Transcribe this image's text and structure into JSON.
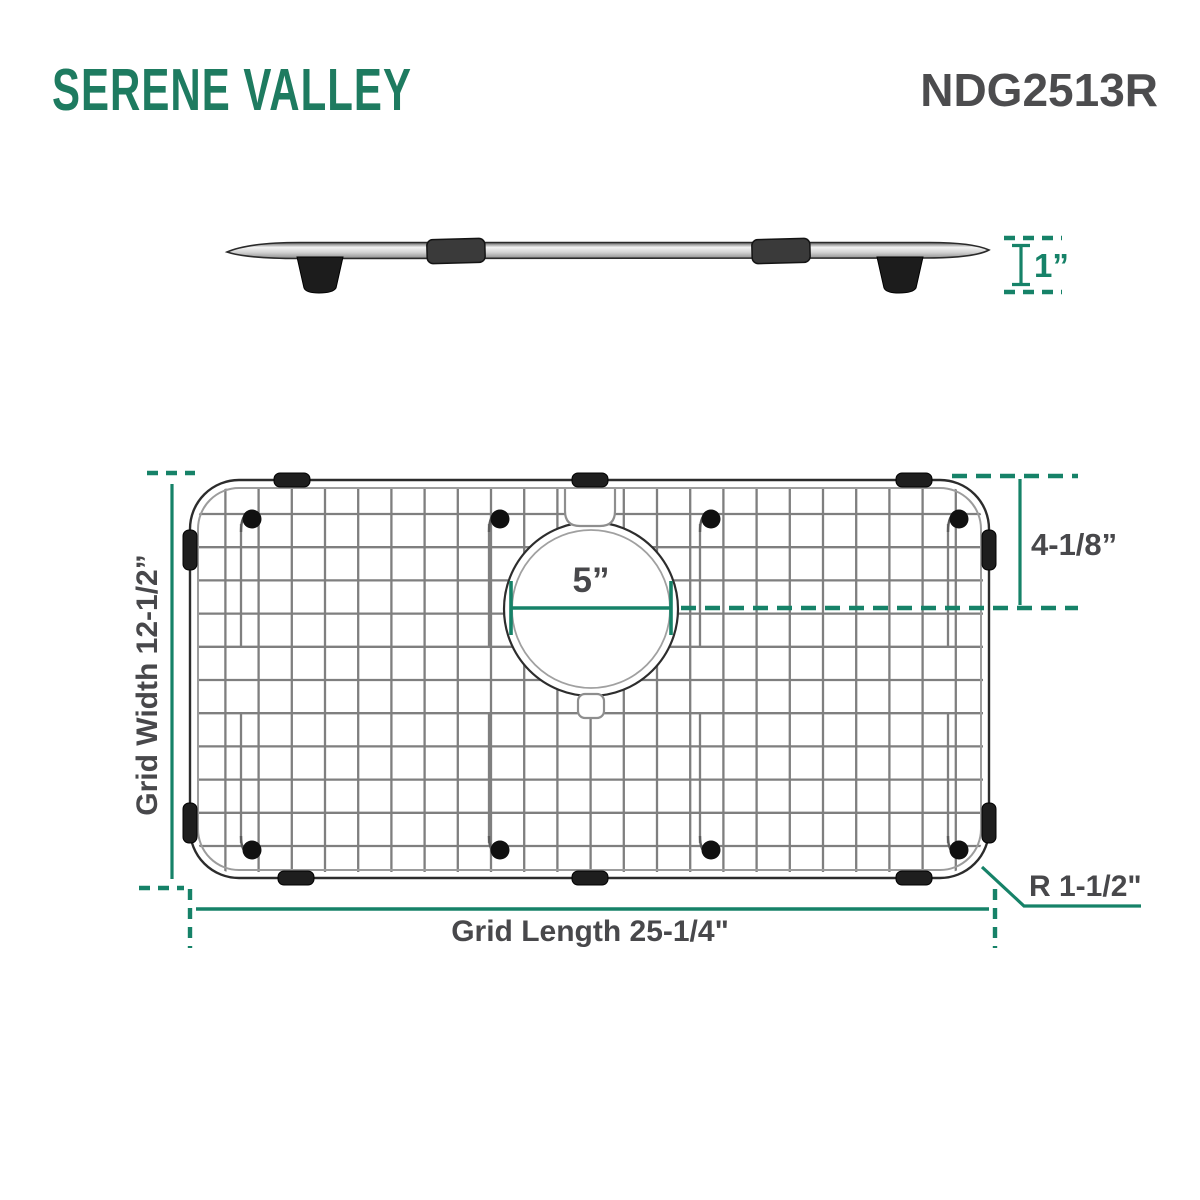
{
  "header": {
    "brand": "SERENE VALLEY",
    "model": "NDG2513R"
  },
  "side_view": {
    "thickness": "1”"
  },
  "top_view": {
    "hole_diameter": "5”",
    "hole_offset": "4-1/8”",
    "grid_width": "Grid Width 12-1/2”",
    "grid_length": "Grid Length 25-1/4\"",
    "corner_radius": "R 1-1/2\""
  },
  "colors": {
    "dimension_green": "#168268",
    "brand_green": "#1e7b60",
    "label_dark": "#48484b"
  }
}
